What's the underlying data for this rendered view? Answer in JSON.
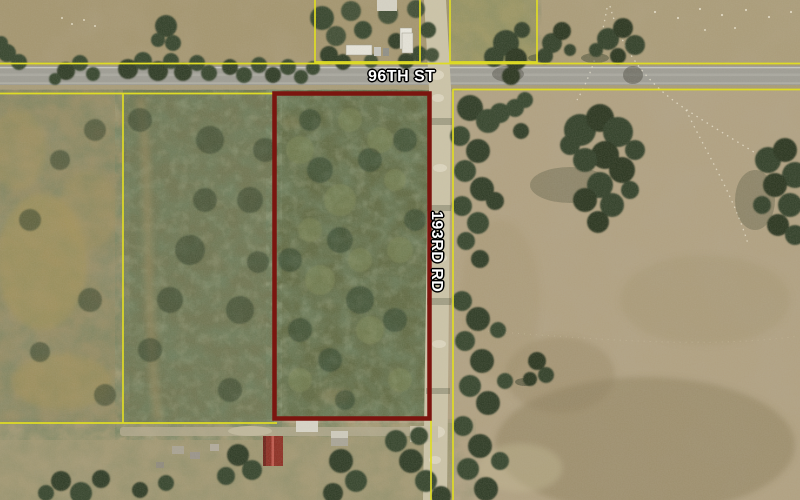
{
  "map": {
    "description": "Aerial parcel map with highlighted property boundary at 96th St and 193rd Rd",
    "road_labels": [
      {
        "id": "96th-st",
        "text": "96TH ST",
        "orientation": "horizontal"
      },
      {
        "id": "193rd-rd",
        "text": "193RD RD",
        "orientation": "vertical"
      }
    ],
    "highlighted_parcel": {
      "outline_color": "#7b150f"
    },
    "parcel_line_color": "#dedb25",
    "label_style": {
      "text_color": "#ffffff",
      "outline_color": "#000000"
    }
  }
}
